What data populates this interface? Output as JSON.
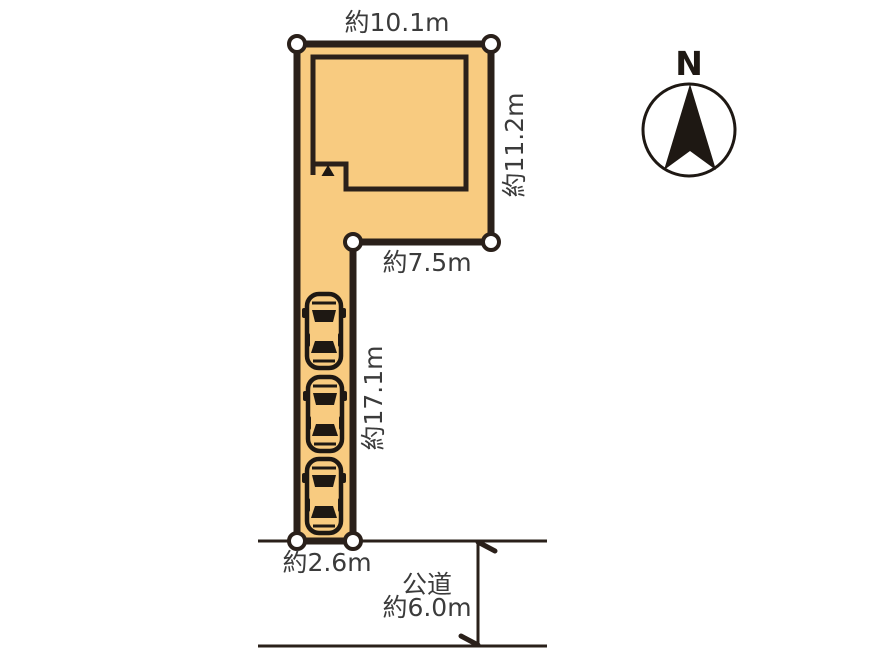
{
  "site_plan": {
    "dimensions": {
      "top_width": "約10.1m",
      "right_depth": "約11.2m",
      "upper_bottom_width": "約7.5m",
      "driveway_length": "約17.1m",
      "frontage_width": "約2.6m"
    },
    "road": {
      "name": "公道",
      "width": "約6.0m"
    },
    "compass": {
      "north_label": "N"
    },
    "lot": {
      "fill_color": "#F8CB80",
      "outline_color": "#2A201A",
      "corner_marker_count": 6
    },
    "parking": {
      "car_count": 3
    }
  }
}
